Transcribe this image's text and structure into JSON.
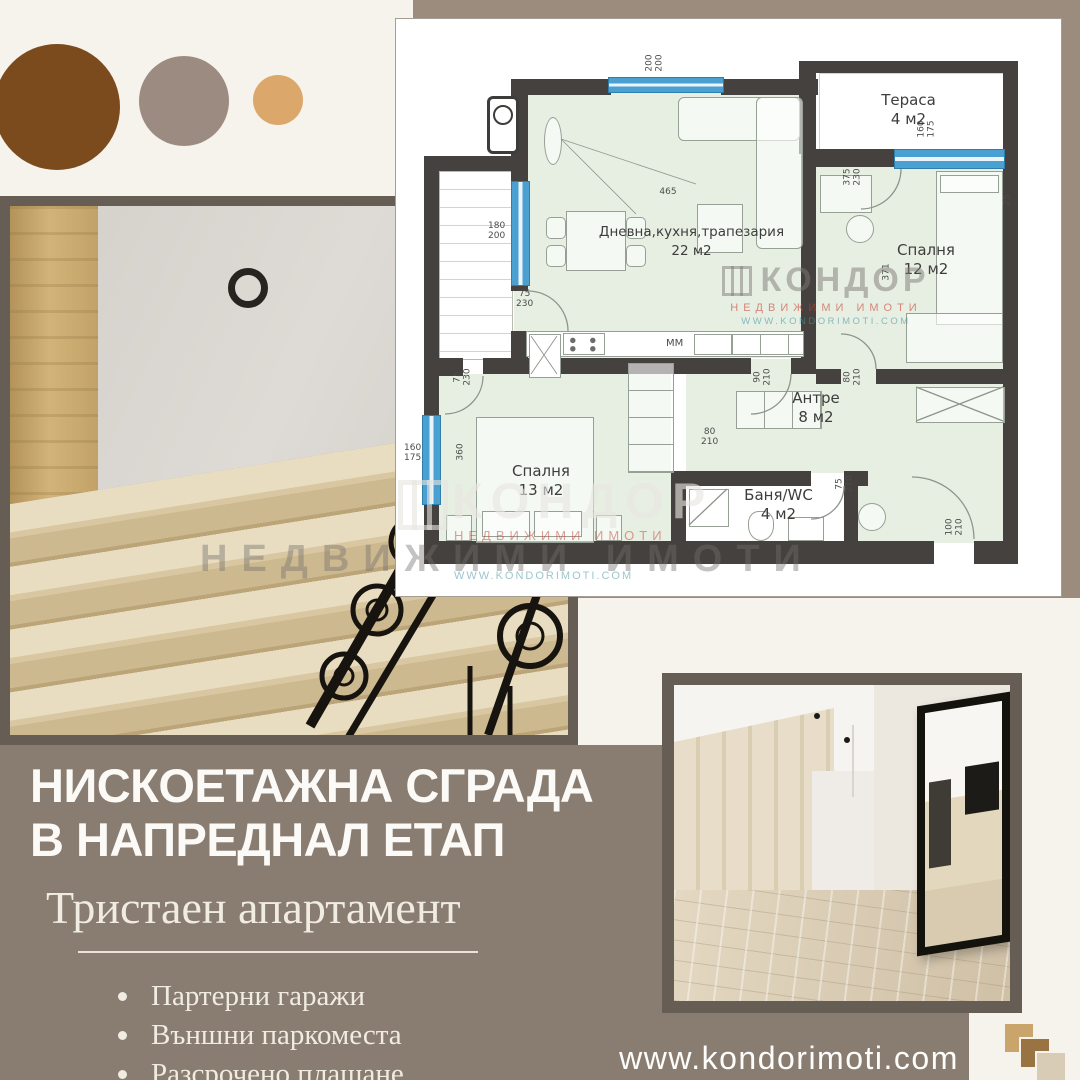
{
  "brand": {
    "watermark_brand": "КОНДОР",
    "watermark_sub": "НЕДВИЖИМИ ИМОТИ",
    "watermark_url": "WWW.KONDORIMOTI.COM",
    "website": "www.kondorimoti.com"
  },
  "headline": {
    "line1": "НИСКОЕТАЖНА СГРАДА",
    "line2": "В НАПРЕДНАЛ ЕТАП",
    "subtitle": "Тристаен апартамент"
  },
  "bullets": [
    {
      "text": "Партерни гаражи"
    },
    {
      "text": "Външни паркоместа"
    },
    {
      "text": "Разсрочено плащане"
    }
  ],
  "plan": {
    "rooms": [
      {
        "name": "Тераса",
        "area": "4 м2"
      },
      {
        "name": "Дневна,кухня,трапезария",
        "area": "22 м2"
      },
      {
        "name": "Спалня",
        "area": "12 м2"
      },
      {
        "name": "Антре",
        "area": "8 м2"
      },
      {
        "name": "Спалня",
        "area": "13 м2"
      },
      {
        "name": "Баня/WC",
        "area": "4 м2"
      }
    ],
    "dims": [
      {
        "t": "200",
        "b": "200"
      },
      {
        "t": "465",
        "b": ""
      },
      {
        "t": "180",
        "b": "200"
      },
      {
        "t": "75",
        "b": "230"
      },
      {
        "t": "160",
        "b": "175"
      },
      {
        "t": "375",
        "b": "230"
      },
      {
        "t": "371",
        "b": ""
      },
      {
        "t": "75",
        "b": "230"
      },
      {
        "t": "360",
        "b": ""
      },
      {
        "t": "160",
        "b": "175"
      },
      {
        "t": "90",
        "b": "210"
      },
      {
        "t": "80",
        "b": "210"
      },
      {
        "t": "80",
        "b": "210"
      },
      {
        "t": "75",
        "b": "210"
      },
      {
        "t": "100",
        "b": "210"
      },
      {
        "t": "MM",
        "b": ""
      },
      {
        "t": "25",
        "b": ""
      }
    ]
  },
  "colors": {
    "accent_brown": "#7b4b1d",
    "accent_taupe": "#9c8b80",
    "accent_tan": "#dca76a",
    "band": "#9c8c7e",
    "panel": "#897c70",
    "frame": "#665d55",
    "plan_green": "#e7efe3",
    "plan_wall": "#45413e",
    "window_blue": "#4aa0d0"
  }
}
